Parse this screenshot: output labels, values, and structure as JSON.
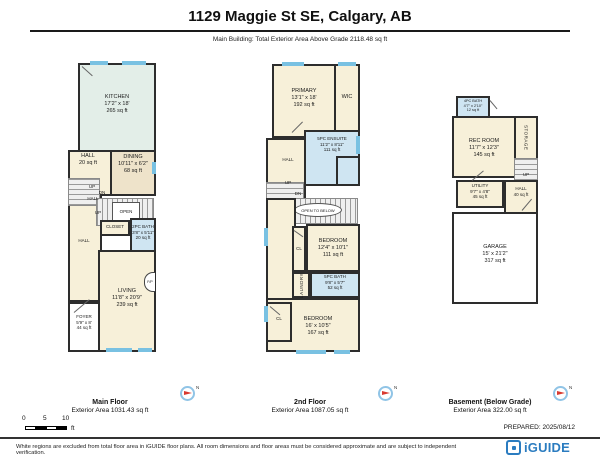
{
  "header": {
    "title": "1129 Maggie St SE, Calgary, AB",
    "subtitle": "Main Building: Total Exterior Area Above Grade 2118.48 sq ft"
  },
  "colors": {
    "wall": "#2d2d2d",
    "room_cream": "#f7f0d9",
    "room_mint": "#e3eee8",
    "room_beige": "#eee3ca",
    "bath_blue": "#cfe5f2",
    "window_blue": "#79c1e2",
    "stair_gray": "#efefef",
    "compass_red": "#d93a30",
    "brand_blue": "#2b7cc0"
  },
  "main_floor": {
    "label": "Main Floor",
    "area_label": "Exterior Area 1031.43 sq ft",
    "kitchen": {
      "name": "KITCHEN",
      "dims": "17'2\" x 18'",
      "area": "265 sq ft"
    },
    "hall_upper": {
      "name": "HALL",
      "area": "20 sq ft"
    },
    "dining": {
      "name": "DINING",
      "dims": "10'11\" x 6'2\"",
      "area": "68 sq ft"
    },
    "up1": "UP",
    "dn": "DN",
    "hall_mid": "HALL",
    "up2": "UP",
    "open": "OPEN",
    "closet": "CLOSET",
    "bath": {
      "name": "2PC BATH",
      "dims": "3'8\" x 5'11\"",
      "area": "20 sq ft"
    },
    "hall_lower": "HALL",
    "living": {
      "name": "LIVING",
      "dims": "11'8\" x 20'9\"",
      "area": "239 sq ft"
    },
    "foyer": {
      "name": "FOYER",
      "dims": "5'9\" x 8'",
      "area": "44 sq ft"
    },
    "fireplace": "F/P"
  },
  "second_floor": {
    "label": "2nd Floor",
    "area_label": "Exterior Area 1087.05 sq ft",
    "primary": {
      "name": "PRIMARY",
      "dims": "13'1\" x 18'",
      "area": "192 sq ft"
    },
    "wic": "WIC",
    "ensuite": {
      "name": "5PC ENSUITE",
      "dims": "11'2\" x 8'11\"",
      "area": "111 sq ft"
    },
    "hall": "HALL",
    "up": "UP",
    "dn": "DN",
    "open_below": "OPEN TO BELOW",
    "bedroom1": {
      "name": "BEDROOM",
      "dims": "12'4\" x 10'1\"",
      "area": "111 sq ft"
    },
    "closet1": "CL",
    "laundry": "LAUNDRY",
    "bath": {
      "name": "5PC BATH",
      "dims": "9'8\" x 5'7\"",
      "area": "52 sq ft"
    },
    "closet2": "CL",
    "bedroom2": {
      "name": "BEDROOM",
      "dims": "16' x 10'5\"",
      "area": "167 sq ft"
    }
  },
  "basement": {
    "label": "Basement (Below Grade)",
    "area_label": "Exterior Area 322.00 sq ft",
    "bath": {
      "name": "4PC BATH",
      "dims": "4'7\" x 2'10\"",
      "area": "12 sq ft"
    },
    "rec_room": {
      "name": "REC ROOM",
      "dims": "11'7\" x 12'3\"",
      "area": "145 sq ft"
    },
    "storage": "STORAGE",
    "up": "UP",
    "hall": {
      "name": "HALL",
      "area": "40 sq ft"
    },
    "utility": {
      "name": "UTILITY",
      "dims": "9'7\" x 4'8\"",
      "area": "45 sq ft"
    },
    "garage": {
      "name": "GARAGE",
      "dims": "15' x 21'2\"",
      "area": "317 sq ft"
    }
  },
  "footer": {
    "scale_ticks": [
      "0",
      "5",
      "10"
    ],
    "scale_unit": "ft",
    "prepared": "PREPARED: 2025/08/12",
    "disclaimer": "White regions are excluded from total floor area in iGUIDE floor plans. All room dimensions and floor areas must be considered approximate and are subject to independent verification.",
    "brand": "iGUIDE",
    "compass_n": "N"
  }
}
